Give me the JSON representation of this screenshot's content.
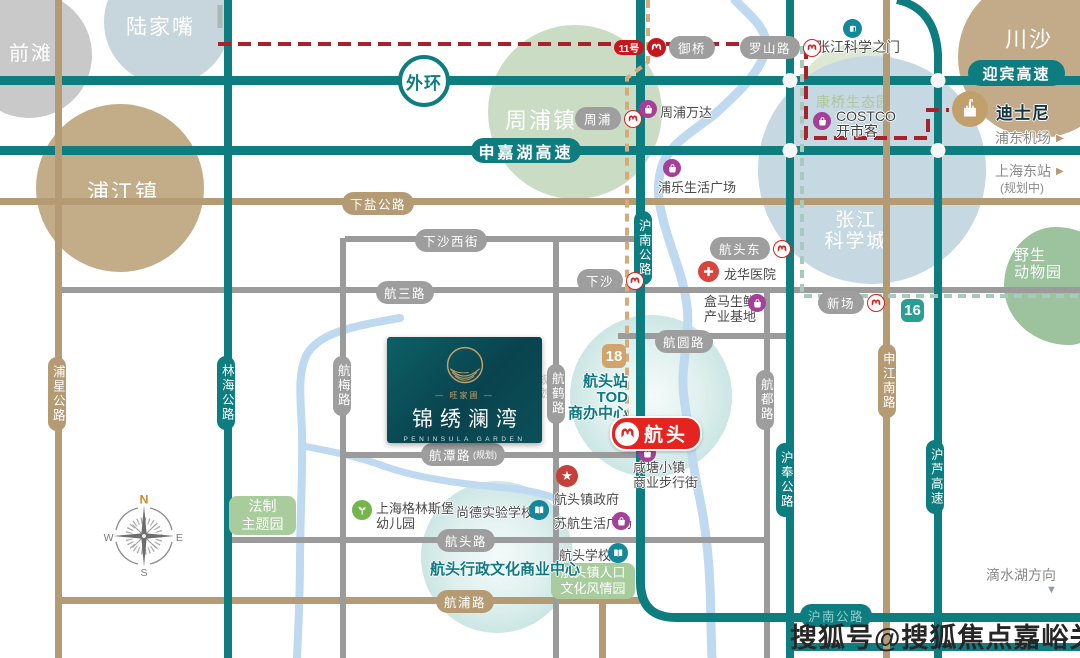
{
  "palette": {
    "road_teal": "#0e7d80",
    "road_tan": "#b49b73",
    "road_gray": "#9b9b9b",
    "line11_red": "#a6232b",
    "line16_mint": "#a6cabb",
    "line18_tan": "#d7ab77",
    "station_red": "#e5231f",
    "poi_purple": "#a63f97",
    "river_blue": "#bed9f0"
  },
  "areas": {
    "qiantan": "前滩",
    "lujiazui": "陆家嘴",
    "pujiangzhen": "浦江镇",
    "zhoupuzhen": "周浦镇",
    "zhangjiang_l1": "张江",
    "zhangjiang_l2": "科学城",
    "chuansha": "川沙",
    "kangqiao": "康桥生态园",
    "safari_l1": "野生",
    "safari_l2": "动物园"
  },
  "badges": {
    "waihuan": "外环",
    "shenjiahu": "申嘉湖高速",
    "yingbin": "迎宾高速",
    "line11": "11号",
    "line18": "18",
    "line16": "16"
  },
  "roads": {
    "xiayan": "下盐公路",
    "xiasha_xijie": "下沙西街",
    "hangsan": "航三路",
    "hangyuan": "航圆路",
    "hangtan": "航潭路",
    "hangtan_note": "(规划)",
    "hangtou_rd": "航头路",
    "hangpu": "航浦路",
    "puxing": "浦星公路",
    "linhai": "林海公路",
    "hangmei": "航梅路",
    "hanghe": "航鹤路",
    "hanghe_note": "规划",
    "hangdu": "航都路",
    "hunan": "沪南公路",
    "hunan_south": "沪南公路",
    "hufeng": "沪奉公路",
    "hulu": "沪芦高速",
    "shenjiang": "申江南路"
  },
  "stations": {
    "yuqiao": "御桥",
    "luoshanlu": "罗山路",
    "zhoupu": "周浦",
    "xiasha": "下沙",
    "hangtoudong": "航头东",
    "xinchang": "新场",
    "hangtou": "航头"
  },
  "pois": {
    "zhangjiang_gate": "张江科学之门",
    "zhoupu_wanda": "周浦万达",
    "costco_en": "COSTCO",
    "costco_cn": "开市客",
    "disney": "迪士尼",
    "pule_plaza": "浦乐生活广场",
    "longhua_hospital": "龙华医院",
    "hema_l1": "盒马生鲜",
    "hema_l2": "产业基地",
    "xiantang_l1": "咸塘小镇",
    "xiantang_l2": "商业步行街",
    "gov": "航头镇政府",
    "suhang_plaza": "苏航生活广场",
    "kindergarten_l1": "上海格林斯堡",
    "kindergarten_l2": "幼儿园",
    "shangde_school": "尚德实验学校",
    "hangtou_school": "航头学校",
    "fazhi_l1": "法制",
    "fazhi_l2": "主题园",
    "renkou_l1": "航头镇人口",
    "renkou_l2": "文化风情园",
    "admin_center": "航头行政文化商业中心",
    "tod_l1": "航头站",
    "tod_l2": "TOD",
    "tod_l3": "商办中心"
  },
  "directions": {
    "pudong_airport": "浦东机场",
    "shanghai_east": "上海东站",
    "planned": "(规划中)",
    "dishuihu": "滴水湖方向",
    "down_arrow": "▼",
    "right_arrow": "▶"
  },
  "property": {
    "brand": "— 旺家圃 —",
    "name": "锦绣澜湾",
    "name_en": "PENINSULA GARDEN"
  },
  "compass": {
    "n": "N",
    "e": "E",
    "s": "S",
    "w": "W"
  },
  "watermark": "搜狐号@搜狐焦点嘉峪关站"
}
